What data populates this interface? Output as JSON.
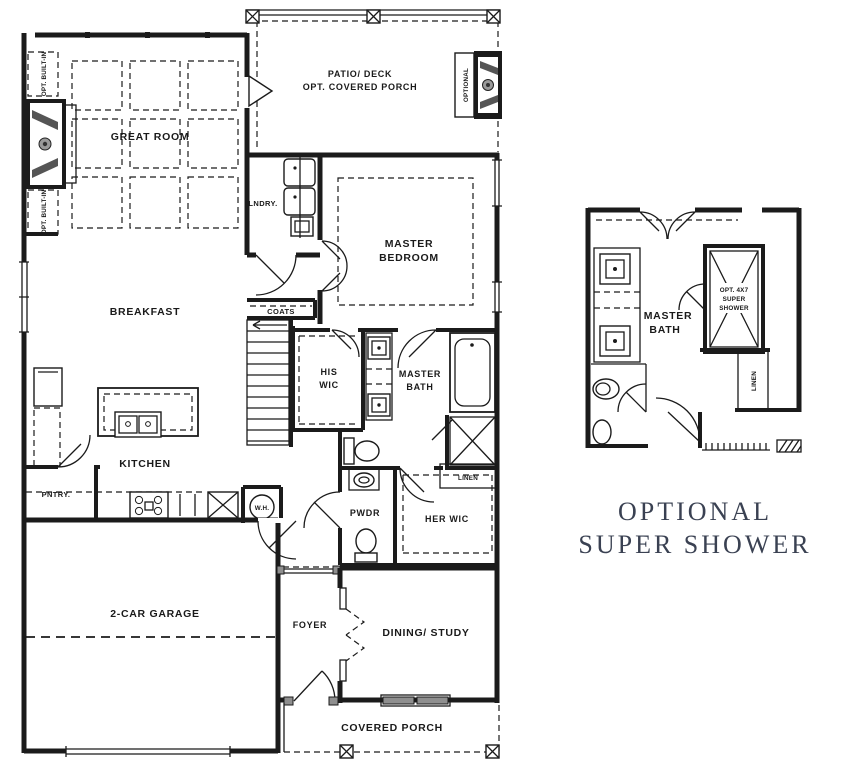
{
  "plan": {
    "labels": {
      "patio_line1": "PATIO/ DECK",
      "patio_line2": "OPT. COVERED PORCH",
      "optional_vertical": "OPTIONAL",
      "opt_built_in": "OPT. BUILT-IN",
      "great_room": "GREAT ROOM",
      "laundry": "LNDRY.",
      "master_bedroom_line1": "MASTER",
      "master_bedroom_line2": "BEDROOM",
      "breakfast": "BREAKFAST",
      "coats": "COATS",
      "his_wic_line1": "HIS",
      "his_wic_line2": "WIC",
      "master_bath_line1": "MASTER",
      "master_bath_line2": "BATH",
      "kitchen": "KITCHEN",
      "pantry": "PNTRY.",
      "water_heater": "W.H.",
      "powder": "PWDR",
      "her_wic": "HER WIC",
      "linen": "LINEN",
      "garage": "2-CAR GARAGE",
      "foyer": "FOYER",
      "dining": "DINING/ STUDY",
      "covered_porch": "COVERED PORCH"
    },
    "inset": {
      "master_bath_line1": "MASTER",
      "master_bath_line2": "BATH",
      "shower_line1": "OPT. 4X7",
      "shower_line2": "SUPER",
      "shower_line3": "SHOWER",
      "linen_vertical": "LINEN"
    },
    "caption": {
      "line1": "OPTIONAL",
      "line2": "SUPER SHOWER"
    },
    "colors": {
      "wall": "#1b1b1b",
      "label": "#1a1a1a",
      "caption": "#3a4152",
      "gray_fill": "#8f8f8f"
    }
  }
}
